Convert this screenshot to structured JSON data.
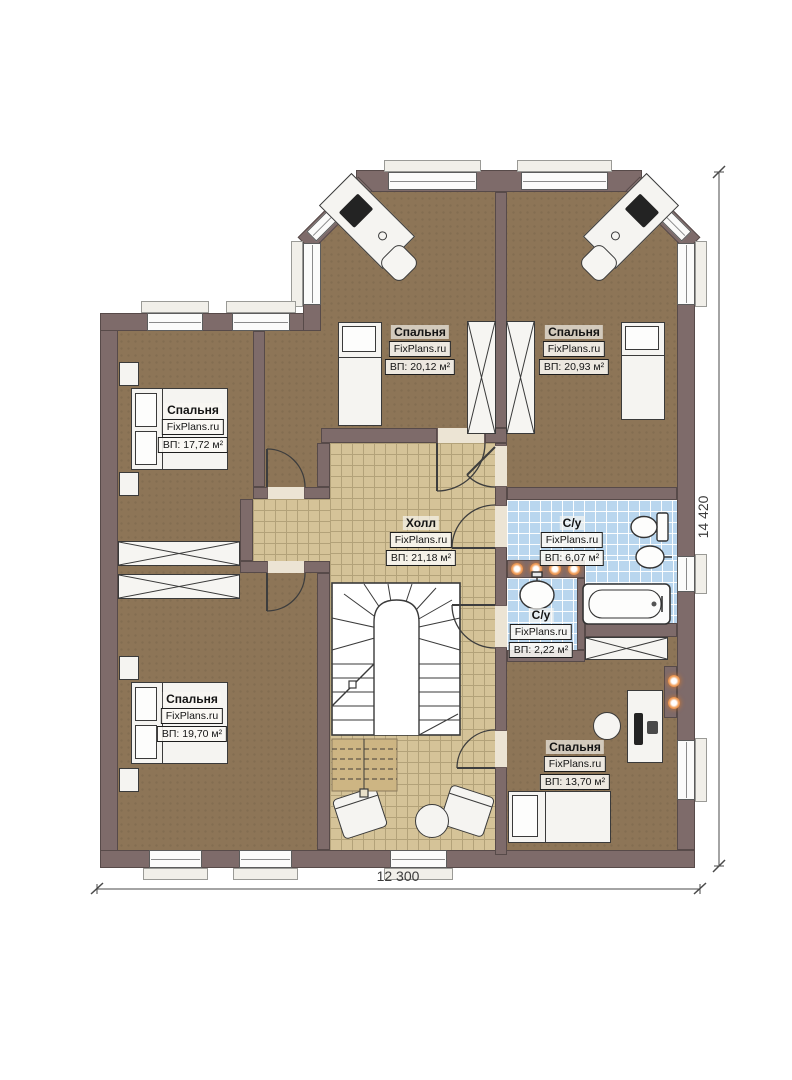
{
  "site": "FixPlans.ru",
  "rooms": {
    "r1": {
      "name": "Спальня",
      "site": "FixPlans.ru",
      "area": "ВП: 20,12 м²"
    },
    "r2": {
      "name": "Спальня",
      "site": "FixPlans.ru",
      "area": "ВП: 20,93 м²"
    },
    "r3": {
      "name": "Спальня",
      "site": "FixPlans.ru",
      "area": "ВП: 17,72 м²"
    },
    "hall": {
      "name": "Холл",
      "site": "FixPlans.ru",
      "area": "ВП: 21,18 м²"
    },
    "wc_big": {
      "name": "С/у",
      "site": "FixPlans.ru",
      "area": "ВП: 6,07 м²"
    },
    "wc_small": {
      "name": "С/у",
      "site": "FixPlans.ru",
      "area": "ВП: 2,22 м²"
    },
    "r7": {
      "name": "Спальня",
      "site": "FixPlans.ru",
      "area": "ВП: 19,70 м²"
    },
    "r8": {
      "name": "Спальня",
      "site": "FixPlans.ru",
      "area": "ВП: 13,70 м²"
    }
  },
  "dimensions": {
    "width_label": "12 300",
    "height_label": "14 420"
  },
  "colors": {
    "wall": "#7e6b6a",
    "floor": "#8d7557",
    "hall_tile": "#d5c398",
    "bath_tile": "#b9d6ee",
    "spotlight": "#cf6a1f"
  }
}
